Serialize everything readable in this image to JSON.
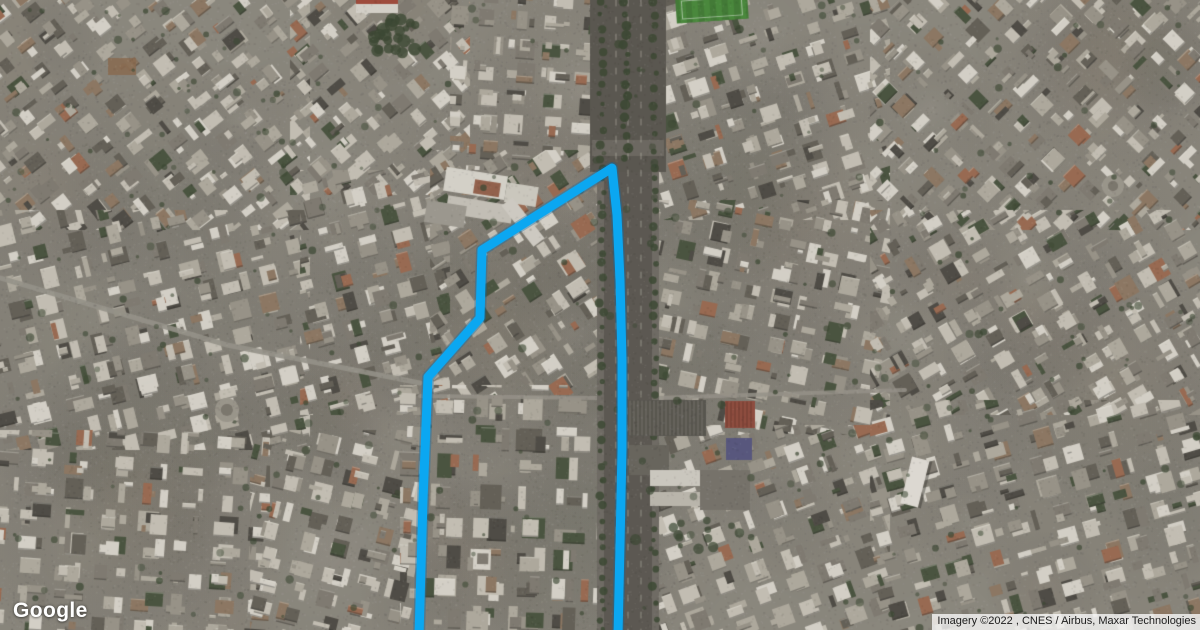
{
  "branding": {
    "logo_text": "Google"
  },
  "attribution": {
    "text": "Imagery ©2022 , CNES / Airbus, Maxar Technologies"
  },
  "map": {
    "imagery_type": "satellite",
    "route": {
      "color": "#0ba7f1",
      "casing_color": "rgba(6,110,175,0.35)",
      "stroke_width": 9,
      "casing_width": 12,
      "points": [
        [
          419,
          636
        ],
        [
          423,
          500
        ],
        [
          428,
          377
        ],
        [
          480,
          318
        ],
        [
          482,
          250
        ],
        [
          612,
          168
        ],
        [
          617,
          215
        ],
        [
          620,
          280
        ],
        [
          622,
          360
        ],
        [
          622,
          450
        ],
        [
          620,
          545
        ],
        [
          618,
          636
        ]
      ]
    }
  }
}
